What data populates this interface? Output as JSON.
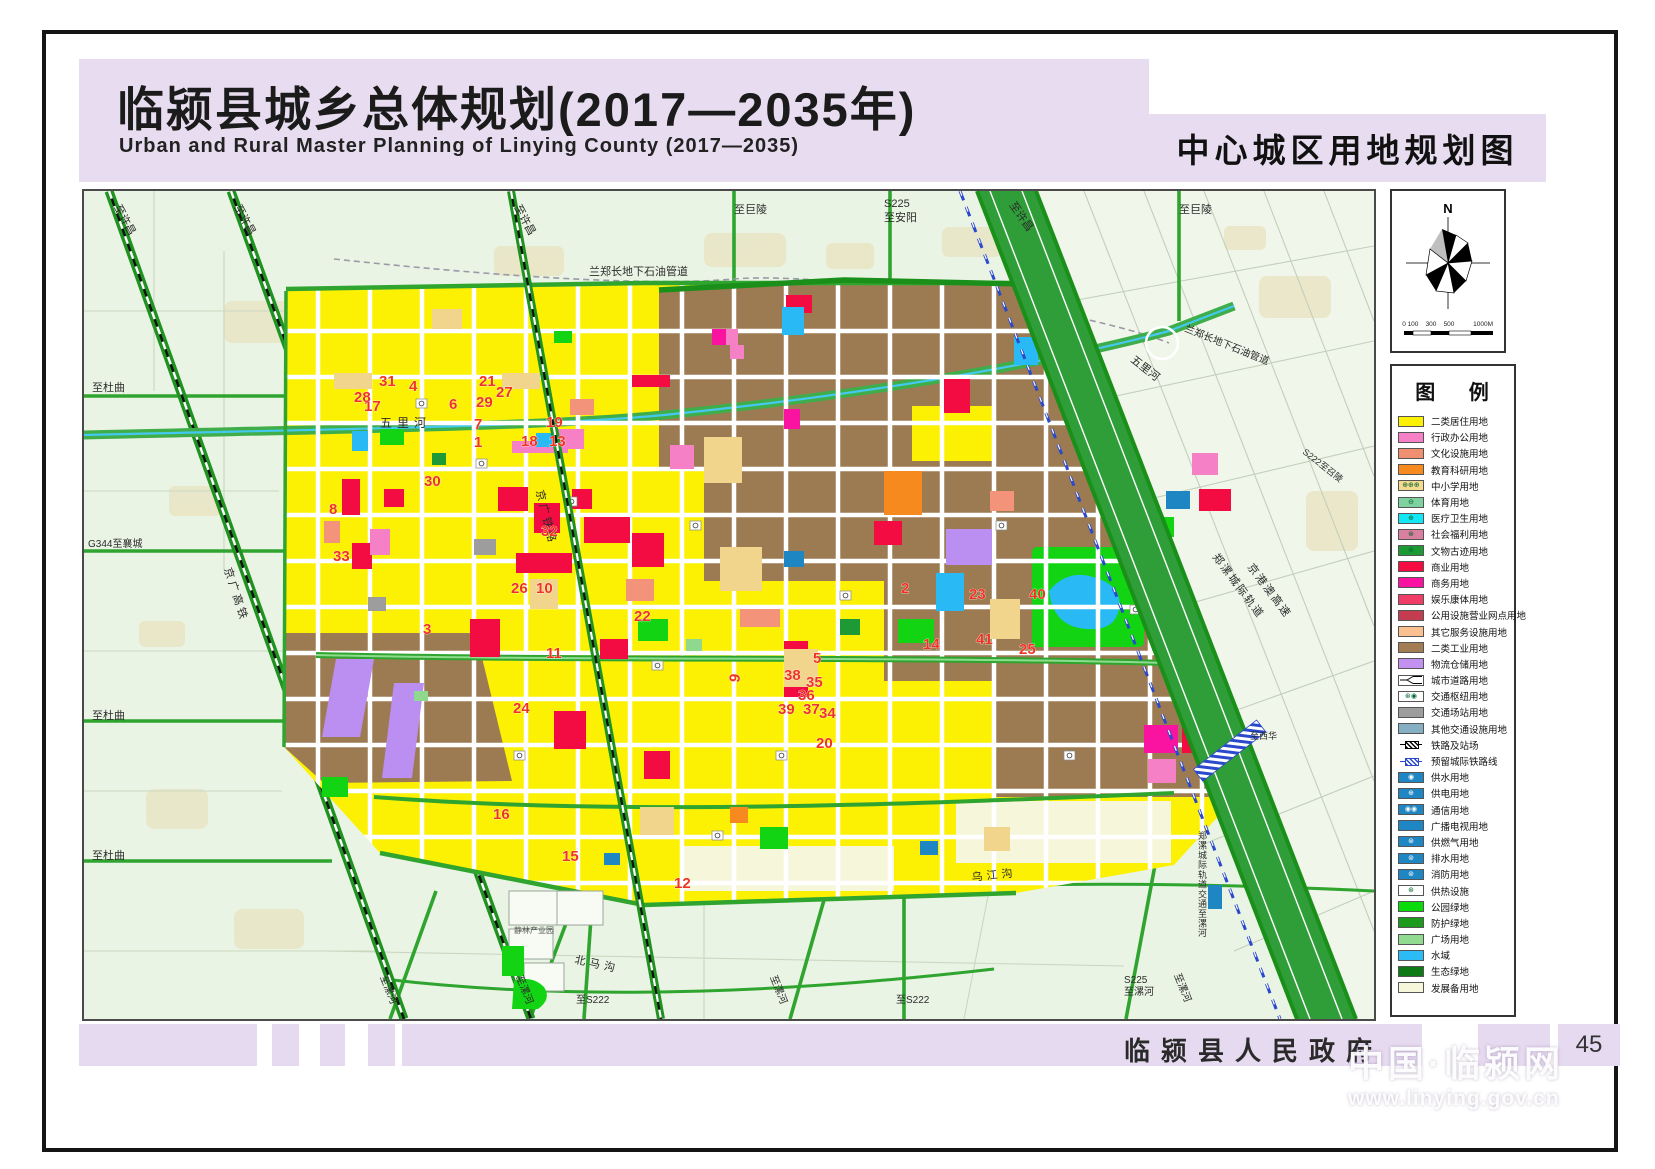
{
  "header": {
    "title_cn": "临颍县城乡总体规划(2017—2035年)",
    "title_en": "Urban and Rural Master Planning of Linying County (2017—2035)",
    "map_title": "中心城区用地规划图"
  },
  "compass": {
    "north": "N",
    "scale_labels": [
      "0",
      "100",
      "300",
      "500",
      "1000M"
    ]
  },
  "legend": {
    "title": "图  例",
    "items": [
      {
        "label": "二类居住用地",
        "type": "plain",
        "color": "#fcf103"
      },
      {
        "label": "行政办公用地",
        "type": "plain",
        "color": "#f580c5"
      },
      {
        "label": "文化设施用地",
        "type": "plain",
        "color": "#f09070"
      },
      {
        "label": "教育科研用地",
        "type": "plain",
        "color": "#f68a1e"
      },
      {
        "label": "中小学用地",
        "type": "school",
        "color": "#f6da8d",
        "sym": "⊕"
      },
      {
        "label": "体育用地",
        "type": "sym",
        "color": "#7fd1a0",
        "sym": "⊖"
      },
      {
        "label": "医疗卫生用地",
        "type": "sym",
        "color": "#12e8f5",
        "sym": "⊕"
      },
      {
        "label": "社会福利用地",
        "type": "sym",
        "color": "#d97fa0",
        "sym": "⊛"
      },
      {
        "label": "文物古迹用地",
        "type": "sym",
        "color": "#1d9a36",
        "sym": "⊚"
      },
      {
        "label": "商业用地",
        "type": "plain",
        "color": "#f50c42"
      },
      {
        "label": "商务用地",
        "type": "plain",
        "color": "#fa12a0"
      },
      {
        "label": "娱乐康体用地",
        "type": "plain",
        "color": "#ef3d68"
      },
      {
        "label": "公用设施营业网点用地",
        "type": "plain",
        "color": "#c33c50"
      },
      {
        "label": "其它服务设施用地",
        "type": "plain",
        "color": "#fbc08f"
      },
      {
        "label": "二类工业用地",
        "type": "plain",
        "color": "#a27c52"
      },
      {
        "label": "物流仓储用地",
        "type": "plain",
        "color": "#c392f0"
      },
      {
        "label": "城市道路用地",
        "type": "road",
        "color": "#ffffff"
      },
      {
        "label": "交通枢纽用地",
        "type": "hub",
        "color": "#ffffff",
        "sym": "⊛◉"
      },
      {
        "label": "交通场站用地",
        "type": "plain",
        "color": "#9d9d9d"
      },
      {
        "label": "其他交通设施用地",
        "type": "plain",
        "color": "#86afc3"
      },
      {
        "label": "铁路及站场",
        "type": "railb",
        "color": "#000000"
      },
      {
        "label": "预留城际铁路线",
        "type": "railblue",
        "color": "#2a49cc"
      },
      {
        "label": "供水用地",
        "type": "sym",
        "color": "#1f86c4",
        "sym": "◉"
      },
      {
        "label": "供电用地",
        "type": "sym",
        "color": "#1f86c4",
        "sym": "⊕"
      },
      {
        "label": "通信用地",
        "type": "sym",
        "color": "#1f86c4",
        "sym": "◉◉"
      },
      {
        "label": "广播电视用地",
        "type": "plain",
        "color": "#1f86c4"
      },
      {
        "label": "供燃气用地",
        "type": "sym",
        "color": "#1f86c4",
        "sym": "⊛"
      },
      {
        "label": "排水用地",
        "type": "sym",
        "color": "#1f86c4",
        "sym": "⊚"
      },
      {
        "label": "消防用地",
        "type": "sym",
        "color": "#1f86c4",
        "sym": "⊚"
      },
      {
        "label": "供热设施",
        "type": "heat",
        "color": "#ffffff",
        "sym": "⊛"
      },
      {
        "label": "公园绿地",
        "type": "plain",
        "color": "#0adb0a"
      },
      {
        "label": "防护绿地",
        "type": "plain",
        "color": "#1b9a1b"
      },
      {
        "label": "广场用地",
        "type": "plain",
        "color": "#90db90"
      },
      {
        "label": "水域",
        "type": "plain",
        "color": "#2bbbf5"
      },
      {
        "label": "生态绿地",
        "type": "plain",
        "color": "#0e7a14"
      },
      {
        "label": "发展备用地",
        "type": "plain",
        "color": "#f6f6da"
      }
    ]
  },
  "map": {
    "numbers": [
      {
        "n": "1",
        "x": 390,
        "y": 256
      },
      {
        "n": "2",
        "x": 817,
        "y": 402
      },
      {
        "n": "3",
        "x": 339,
        "y": 443
      },
      {
        "n": "4",
        "x": 325,
        "y": 200
      },
      {
        "n": "5",
        "x": 729,
        "y": 472
      },
      {
        "n": "6",
        "x": 365,
        "y": 218
      },
      {
        "n": "7",
        "x": 390,
        "y": 238
      },
      {
        "n": "8",
        "x": 245,
        "y": 323
      },
      {
        "n": "9",
        "x": 655,
        "y": 492,
        "r": -80
      },
      {
        "n": "10",
        "x": 452,
        "y": 402
      },
      {
        "n": "11",
        "x": 462,
        "y": 467
      },
      {
        "n": "12",
        "x": 590,
        "y": 697
      },
      {
        "n": "13",
        "x": 465,
        "y": 255
      },
      {
        "n": "14",
        "x": 839,
        "y": 458
      },
      {
        "n": "15",
        "x": 478,
        "y": 670
      },
      {
        "n": "16",
        "x": 409,
        "y": 628
      },
      {
        "n": "17",
        "x": 280,
        "y": 220
      },
      {
        "n": "18",
        "x": 437,
        "y": 255
      },
      {
        "n": "19",
        "x": 462,
        "y": 236
      },
      {
        "n": "20",
        "x": 732,
        "y": 557
      },
      {
        "n": "21",
        "x": 395,
        "y": 195
      },
      {
        "n": "22",
        "x": 550,
        "y": 430
      },
      {
        "n": "23",
        "x": 885,
        "y": 408
      },
      {
        "n": "24",
        "x": 429,
        "y": 522
      },
      {
        "n": "25",
        "x": 935,
        "y": 463
      },
      {
        "n": "26",
        "x": 427,
        "y": 402
      },
      {
        "n": "27",
        "x": 412,
        "y": 206
      },
      {
        "n": "28",
        "x": 270,
        "y": 211
      },
      {
        "n": "29",
        "x": 392,
        "y": 216
      },
      {
        "n": "30",
        "x": 340,
        "y": 295
      },
      {
        "n": "31",
        "x": 295,
        "y": 195
      },
      {
        "n": "32",
        "x": 457,
        "y": 345
      },
      {
        "n": "33",
        "x": 249,
        "y": 370
      },
      {
        "n": "34",
        "x": 735,
        "y": 527
      },
      {
        "n": "35",
        "x": 722,
        "y": 496
      },
      {
        "n": "36",
        "x": 714,
        "y": 509
      },
      {
        "n": "37",
        "x": 719,
        "y": 523
      },
      {
        "n": "38",
        "x": 700,
        "y": 489
      },
      {
        "n": "39",
        "x": 694,
        "y": 523
      },
      {
        "n": "40",
        "x": 945,
        "y": 408
      },
      {
        "n": "41",
        "x": 892,
        "y": 453
      }
    ],
    "labels": [
      {
        "t": "至许昌",
        "x": 30,
        "y": 16,
        "r": 62,
        "s": 11
      },
      {
        "t": "至许昌",
        "x": 150,
        "y": 16,
        "r": 62,
        "s": 11
      },
      {
        "t": "至许昌",
        "x": 430,
        "y": 16,
        "r": 62,
        "s": 11
      },
      {
        "t": "至巨陵",
        "x": 650,
        "y": 22,
        "s": 11
      },
      {
        "t": "S225",
        "x": 800,
        "y": 16,
        "s": 11
      },
      {
        "t": "至安阳",
        "x": 800,
        "y": 30,
        "s": 11
      },
      {
        "t": "至许昌",
        "x": 925,
        "y": 14,
        "r": 55,
        "s": 11
      },
      {
        "t": "至巨陵",
        "x": 1095,
        "y": 22,
        "s": 11
      },
      {
        "t": "兰郑长地下石油管道",
        "x": 505,
        "y": 84,
        "s": 11
      },
      {
        "t": "兰郑长地下石油管道",
        "x": 1100,
        "y": 140,
        "r": 22,
        "s": 10
      },
      {
        "t": "五里河",
        "x": 296,
        "y": 236,
        "s": 12,
        "ls": 5
      },
      {
        "t": "五里河",
        "x": 1046,
        "y": 170,
        "r": 38,
        "s": 11
      },
      {
        "t": "京广铁路",
        "x": 452,
        "y": 300,
        "r": 76,
        "s": 11,
        "ls": 3
      },
      {
        "t": "京广高铁",
        "x": 140,
        "y": 378,
        "r": 72,
        "s": 11,
        "ls": 3
      },
      {
        "t": "至杜曲",
        "x": 8,
        "y": 200,
        "s": 11
      },
      {
        "t": "G344至襄城",
        "x": 4,
        "y": 356,
        "s": 10
      },
      {
        "t": "至杜曲",
        "x": 8,
        "y": 528,
        "s": 11
      },
      {
        "t": "至杜曲",
        "x": 8,
        "y": 668,
        "s": 11
      },
      {
        "t": "至漯河",
        "x": 296,
        "y": 786,
        "r": 68,
        "s": 10
      },
      {
        "t": "至漯河",
        "x": 432,
        "y": 786,
        "r": 68,
        "s": 10
      },
      {
        "t": "至S222",
        "x": 492,
        "y": 812,
        "s": 10
      },
      {
        "t": "至漯河",
        "x": 686,
        "y": 786,
        "r": 68,
        "s": 10
      },
      {
        "t": "至S222",
        "x": 812,
        "y": 812,
        "s": 10
      },
      {
        "t": "乌江沟",
        "x": 888,
        "y": 690,
        "r": -6,
        "s": 11,
        "ls": 4
      },
      {
        "t": "北马沟",
        "x": 490,
        "y": 772,
        "r": 12,
        "s": 11,
        "ls": 4
      },
      {
        "t": "S225",
        "x": 1040,
        "y": 792,
        "s": 10
      },
      {
        "t": "至漯河",
        "x": 1040,
        "y": 804,
        "s": 10
      },
      {
        "t": "至漯河",
        "x": 1090,
        "y": 784,
        "r": 68,
        "s": 10
      },
      {
        "t": "郑漯城际轨道",
        "x": 1128,
        "y": 366,
        "r": 53,
        "s": 11,
        "ls": 2
      },
      {
        "t": "京港澳高速",
        "x": 1163,
        "y": 376,
        "r": 53,
        "s": 11,
        "ls": 2
      },
      {
        "t": "郑漯城际轨道交通至漯河",
        "x": 1114,
        "y": 648,
        "v": 1,
        "s": 9
      },
      {
        "t": "至西华",
        "x": 1166,
        "y": 548,
        "s": 9
      },
      {
        "t": "S222至召陵",
        "x": 1218,
        "y": 262,
        "r": 38,
        "s": 9
      },
      {
        "t": "静林产业园",
        "x": 430,
        "y": 742,
        "s": 8,
        "c": "#555"
      }
    ]
  },
  "footer": {
    "government": "临颍县人民政府",
    "page": "45",
    "watermark_title": "中国·临颍网",
    "watermark_url": "www.linying.gov.cn"
  }
}
